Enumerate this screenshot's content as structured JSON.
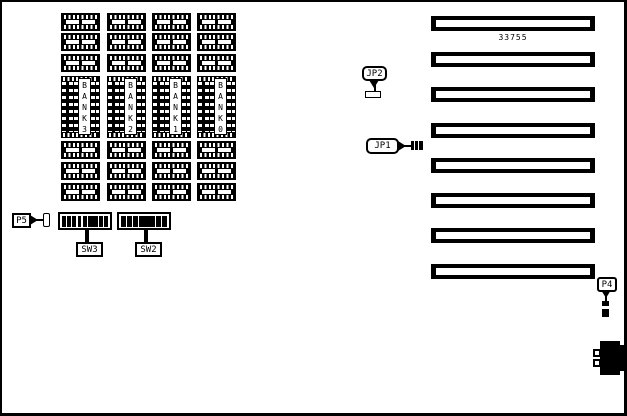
{
  "board": {
    "part_number": "33755",
    "memory_banks": [
      {
        "name": "BANK 3",
        "vertical_label": "B\nA\nN\nK\n3"
      },
      {
        "name": "BANK 2",
        "vertical_label": "B\nA\nN\nK\n2"
      },
      {
        "name": "BANK 1",
        "vertical_label": "B\nA\nN\nK\n1"
      },
      {
        "name": "BANK 0",
        "vertical_label": "B\nA\nN\nK\n0"
      }
    ],
    "expansion_slot_count": 8,
    "jumpers": {
      "jp2": "JP2",
      "jp1": "JP1"
    },
    "connectors": {
      "p5": "P5",
      "p4": "P4"
    },
    "switches": [
      {
        "label": "SW3",
        "segment_weights": [
          1,
          1,
          1,
          1,
          1,
          2.5,
          1,
          1
        ]
      },
      {
        "label": "SW2",
        "segment_weights": [
          1,
          1,
          1,
          3.5,
          1,
          1
        ]
      }
    ],
    "colors": {
      "ink": "#000000",
      "paper": "#ffffff"
    }
  }
}
